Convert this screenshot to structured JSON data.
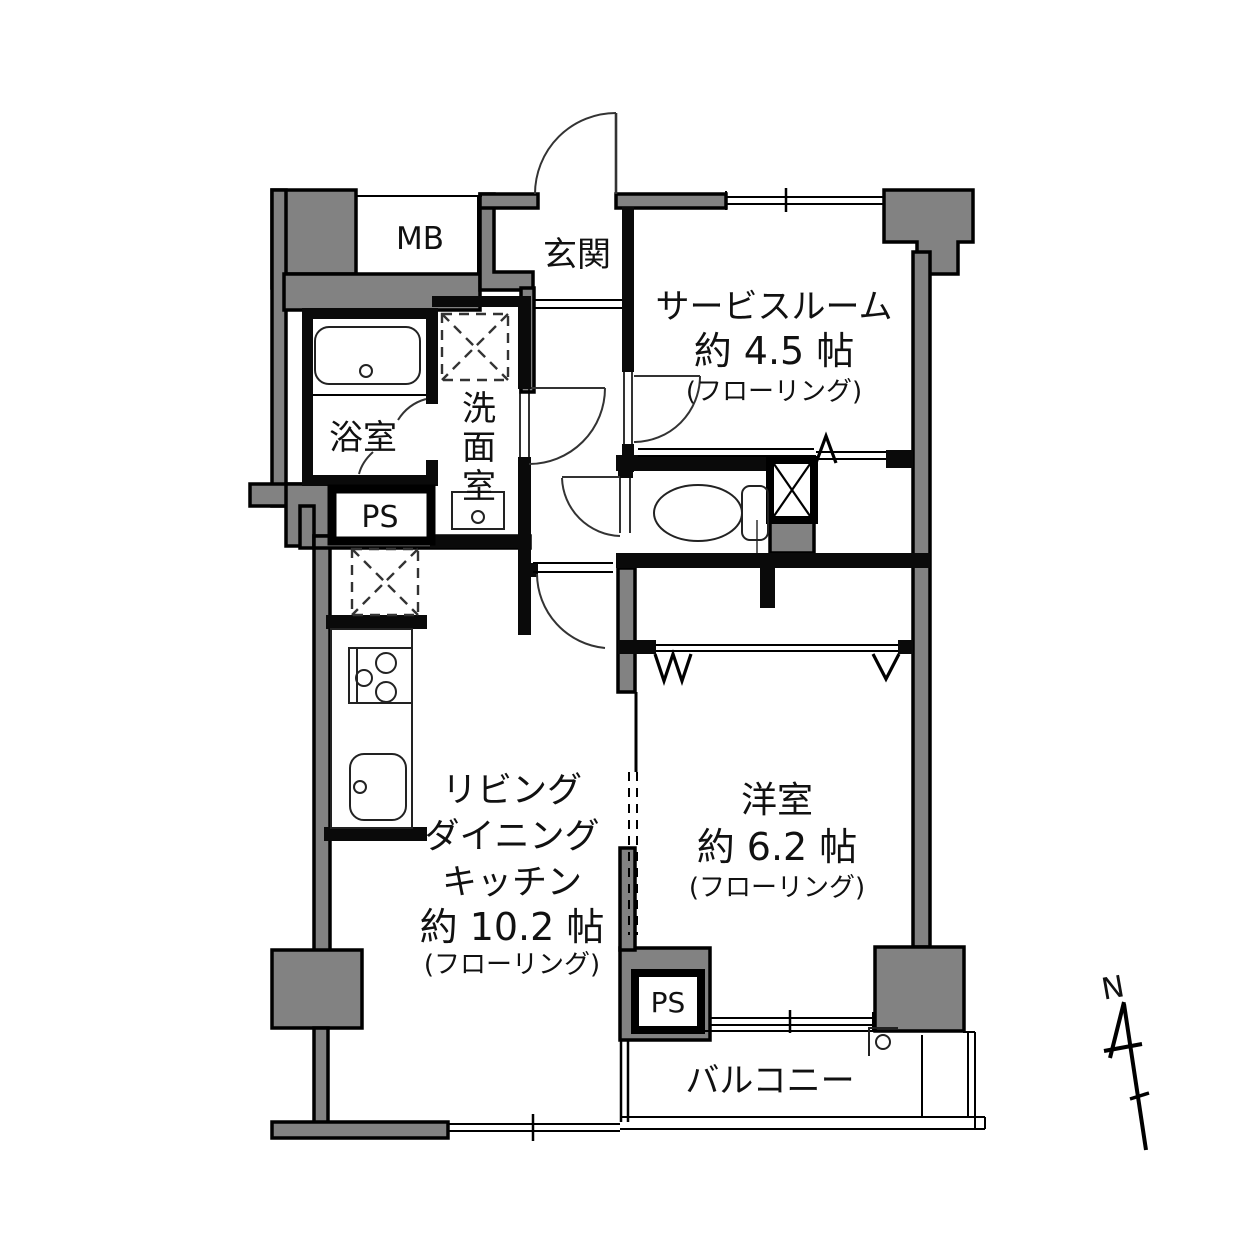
{
  "plan": {
    "rooms": {
      "mb": {
        "label": "MB"
      },
      "genkan": {
        "label": "玄関"
      },
      "service_room": {
        "name": "サービスルーム",
        "size": "約 4.5 帖",
        "floor": "(フローリング)"
      },
      "bathroom": {
        "label": "浴室"
      },
      "washroom": {
        "chars": [
          "洗",
          "面",
          "室"
        ]
      },
      "ps_upper": {
        "label": "PS"
      },
      "ldk": {
        "line1": "リビング",
        "line2": "ダイニング",
        "line3": "キッチン",
        "size": "約 10.2 帖",
        "floor": "(フローリング)"
      },
      "western_room": {
        "name": "洋室",
        "size": "約 6.2 帖",
        "floor": "(フローリング)"
      },
      "ps_lower": {
        "label": "PS"
      },
      "balcony": {
        "label": "バルコニー"
      }
    },
    "compass": {
      "label": "N"
    },
    "colors": {
      "wall_gray": "#828282",
      "line_black": "#000000"
    }
  }
}
